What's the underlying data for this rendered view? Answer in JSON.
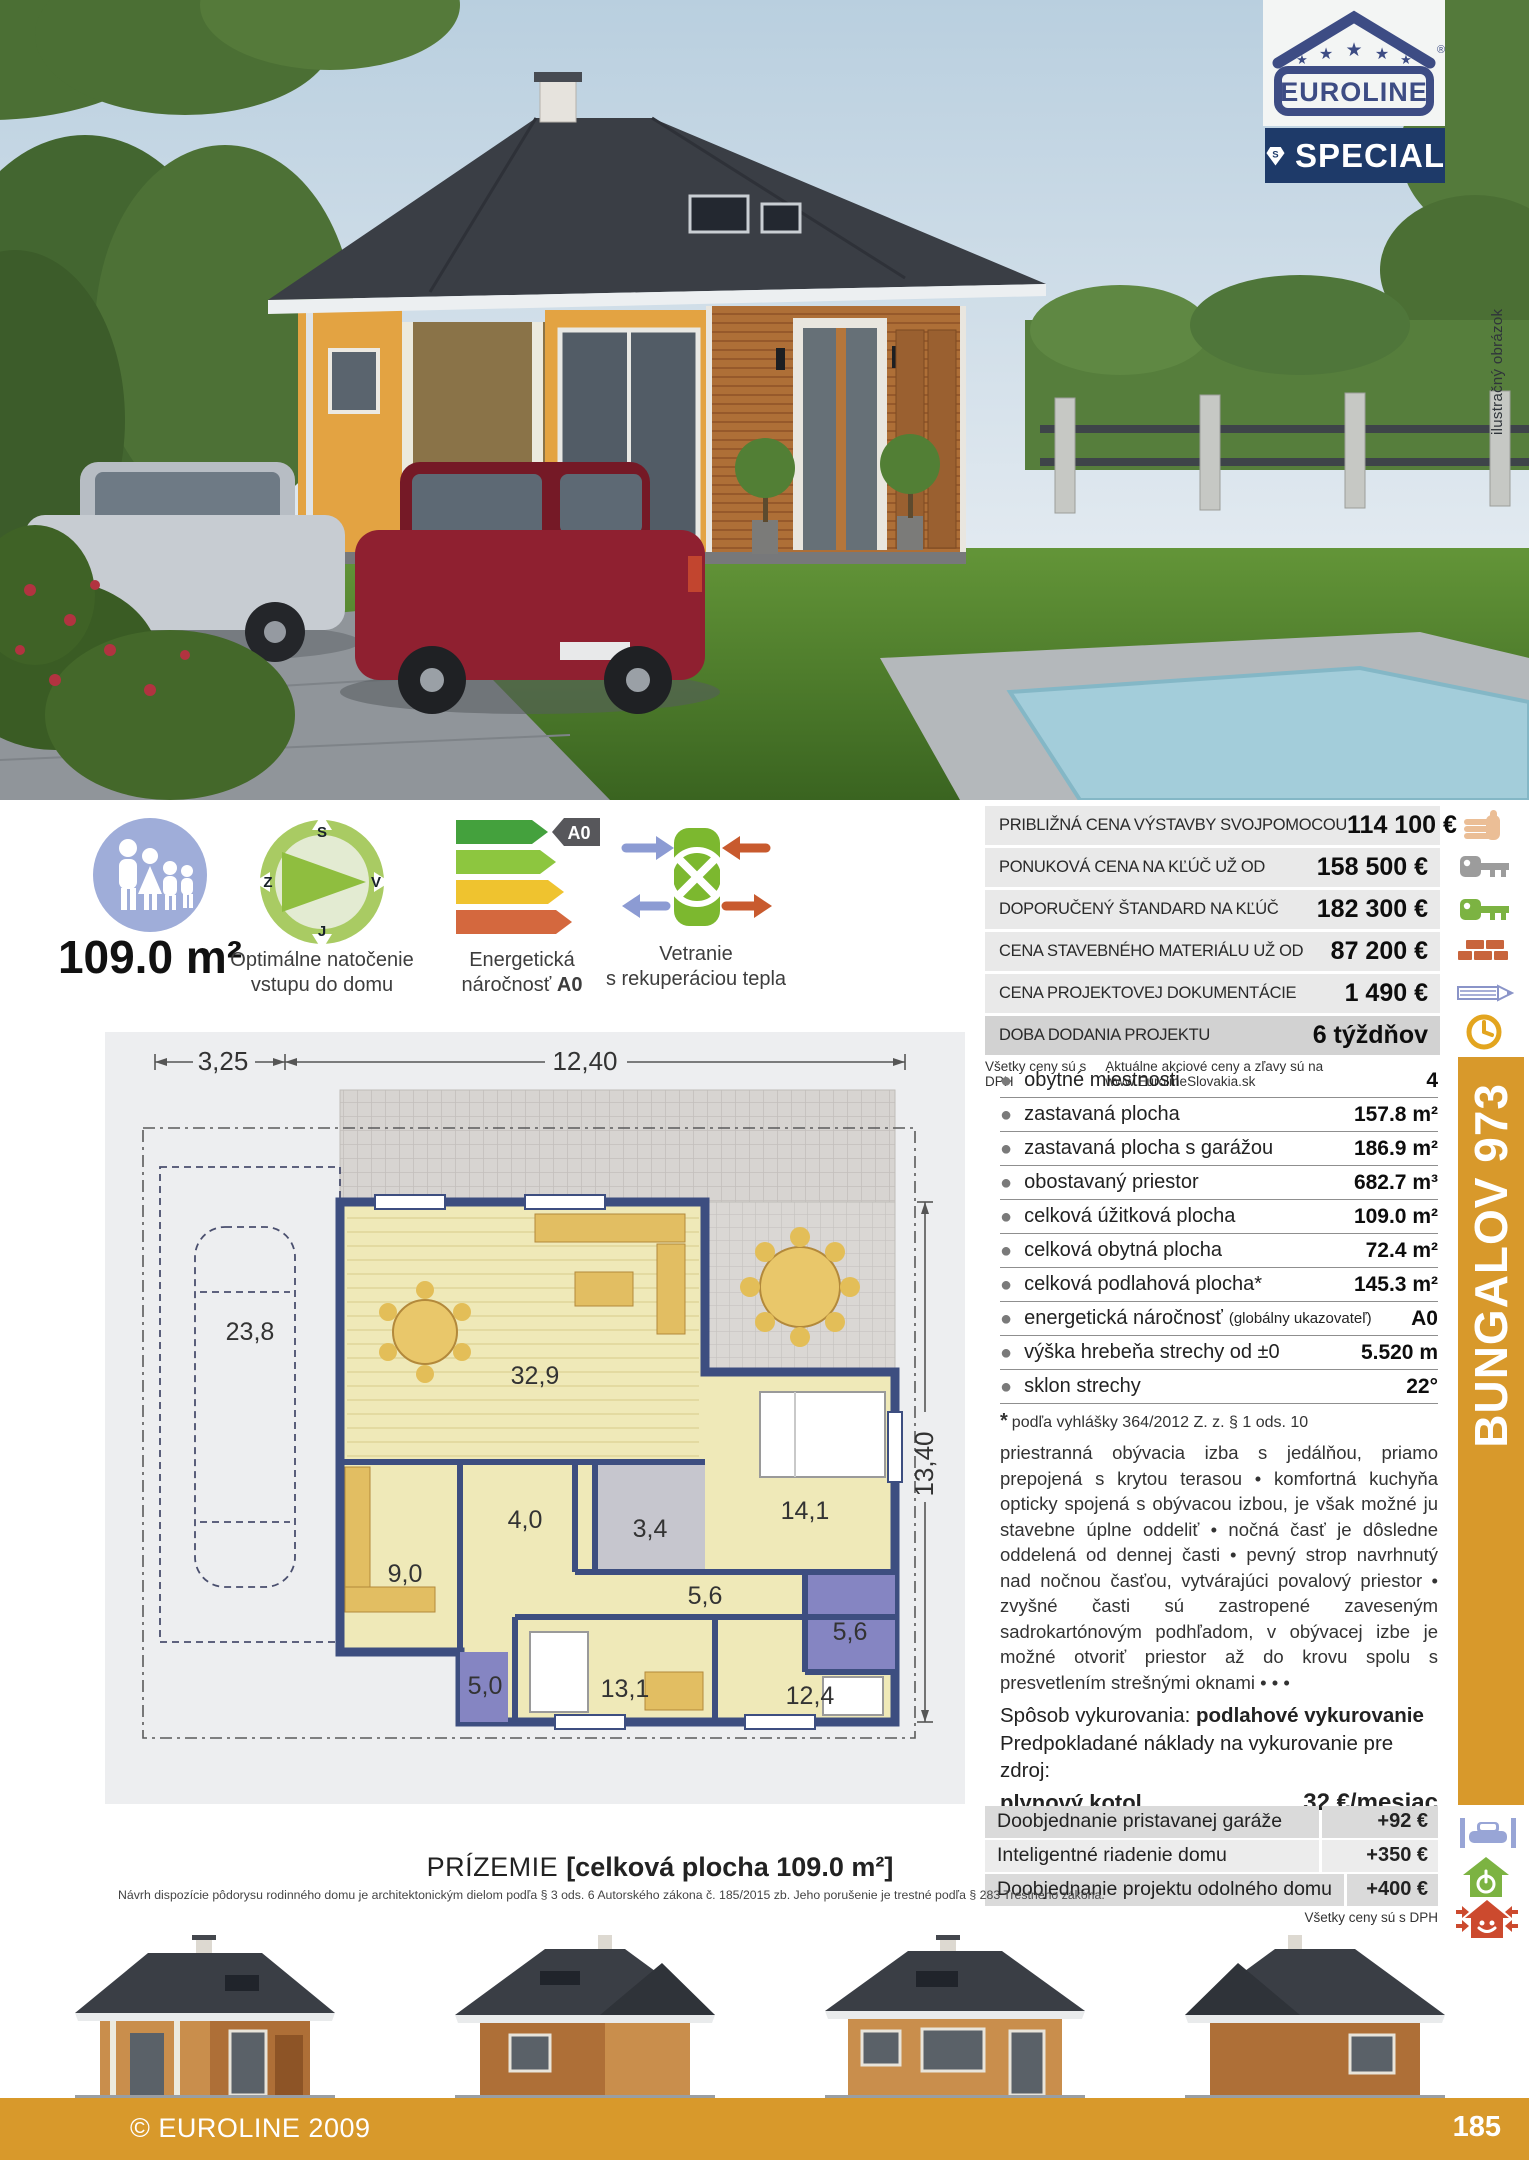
{
  "logo": {
    "brand": "EUROLINE",
    "registered": "®",
    "special": "SPECIAL",
    "monogram": "S"
  },
  "photo": {
    "caption_vertical": "ilustračný obrázok"
  },
  "features": {
    "area": "109.0 m²",
    "compass": {
      "caption1": "Optimálne natočenie",
      "caption2": "vstupu do domu",
      "n": "S",
      "e": "V",
      "s": "J",
      "w": "Z"
    },
    "energy": {
      "caption1": "Energetická",
      "caption2_prefix": "náročnosť ",
      "badge": "A0"
    },
    "vent": {
      "caption1": "Vetranie",
      "caption2": "s rekuperáciou tepla"
    }
  },
  "prices": {
    "rows": [
      {
        "label": "PRIBLIŽNÁ CENA VÝSTAVBY SVOJPOMOCOU",
        "value": "114 100 €"
      },
      {
        "label": "PONUKOVÁ CENA NA KĽÚČ UŽ OD",
        "value": "158 500 €"
      },
      {
        "label": "DOPORUČENÝ ŠTANDARD NA KĽÚČ",
        "value": "182 300 €"
      },
      {
        "label": "CENA STAVEBNÉHO MATERIÁLU UŽ OD",
        "value": "87 200 €"
      },
      {
        "label": "CENA PROJEKTOVEJ DOKUMENTÁCIE",
        "value": "1 490 €"
      },
      {
        "label": "DOBA DODANIA PROJEKTU",
        "value": "6 týždňov"
      }
    ],
    "fineprint_left": "Všetky ceny sú s DPH",
    "fineprint_right": "Aktuálne akciové ceny a zľavy sú na www.EurolineSlovakia.sk"
  },
  "specs": {
    "rows": [
      {
        "label": "obytné miestnosti",
        "extra": "",
        "value": "4"
      },
      {
        "label": "zastavaná plocha",
        "extra": "",
        "value": "157.8 m²"
      },
      {
        "label": "zastavaná plocha s garážou",
        "extra": "",
        "value": "186.9 m²"
      },
      {
        "label": "obostavaný priestor",
        "extra": "",
        "value": "682.7 m³"
      },
      {
        "label": "celková úžitková plocha",
        "extra": "",
        "value": "109.0 m²"
      },
      {
        "label": "celková obytná plocha",
        "extra": "",
        "value": "72.4 m²"
      },
      {
        "label": "celková podlahová plocha*",
        "extra": "",
        "value": "145.3 m²"
      },
      {
        "label": "energetická náročnosť",
        "extra": "(globálny ukazovateľ)",
        "value": "A0"
      },
      {
        "label": "výška hrebeňa strechy od ±0",
        "extra": "",
        "value": "5.520 m"
      },
      {
        "label": "sklon strechy",
        "extra": "",
        "value": "22°"
      }
    ],
    "footnote_star": "*",
    "footnote": "podľa vyhlášky 364/2012 Z. z. § 1 ods. 10"
  },
  "description": "priestranná obývacia izba s jedálňou, priamo prepojená s krytou terasou  •  komfortná kuchyňa opticky spojená s obývacou izbou, je však možné ju stavebne úplne oddeliť  •  nočná časť je dôsledne oddelená od dennej časti  •  pevný strop navrhnutý nad nočnou časťou, vytvárajúci povalový priestor  •  zvyšné časti sú zastropené zaveseným sadrokartónovým podhľadom, v obývacej izbe je možné otvoriť priestor až do krovu spolu s presvetlením strešnými oknami  • • •",
  "heating": {
    "line1_label": "Spôsob vykurovania: ",
    "line1_bold": "podlahové vykurovanie",
    "line2": "Predpokladané náklady na vykurovanie pre zdroj:",
    "line3_bold": "plynový kotol",
    "line3_value": "32 €/mesiac"
  },
  "options": {
    "rows": [
      {
        "label": "Doobjednanie pristavanej garáže",
        "value": "+92 €"
      },
      {
        "label": "Inteligentné riadenie domu",
        "value": "+350 €"
      },
      {
        "label": "Doobjednanie projektu odolného domu",
        "value": "+400 €"
      }
    ],
    "fineprint": "Všetky ceny sú s DPH"
  },
  "plan": {
    "dim_top_left": "3,25",
    "dim_top_right": "12,40",
    "dim_right": "13,40",
    "rooms": {
      "garage": "23,8",
      "living": "32,9",
      "hall": "4,0",
      "bath1": "3,4",
      "bedroom1": "14,1",
      "kitchen": "9,0",
      "corridor": "5,6",
      "bath2": "5,6",
      "wc": "5,0",
      "bedroom2": "13,1",
      "bedroom3": "12,4"
    },
    "caption_level": "PRÍZEMIE ",
    "caption_area": "[celková plocha 109.0 m²]",
    "legal": "Návrh dispozície pôdorysu rodinného domu je architektonickým dielom podľa § 3 ods. 6 Autorského zákona č. 185/2015 zb. Jeho porušenie je trestné podľa § 283 Trestného zákona."
  },
  "sidebar": {
    "title": "BUNGALOV 973"
  },
  "footer": {
    "copyright": "© EUROLINE 2009",
    "page": "185"
  },
  "colors": {
    "accent_orange": "#D8992B",
    "navy": "#3D4C84",
    "navy_dark": "#1E3A69",
    "row_gray": "#E9E9E9",
    "row_gray_dark": "#D2D2D2"
  }
}
